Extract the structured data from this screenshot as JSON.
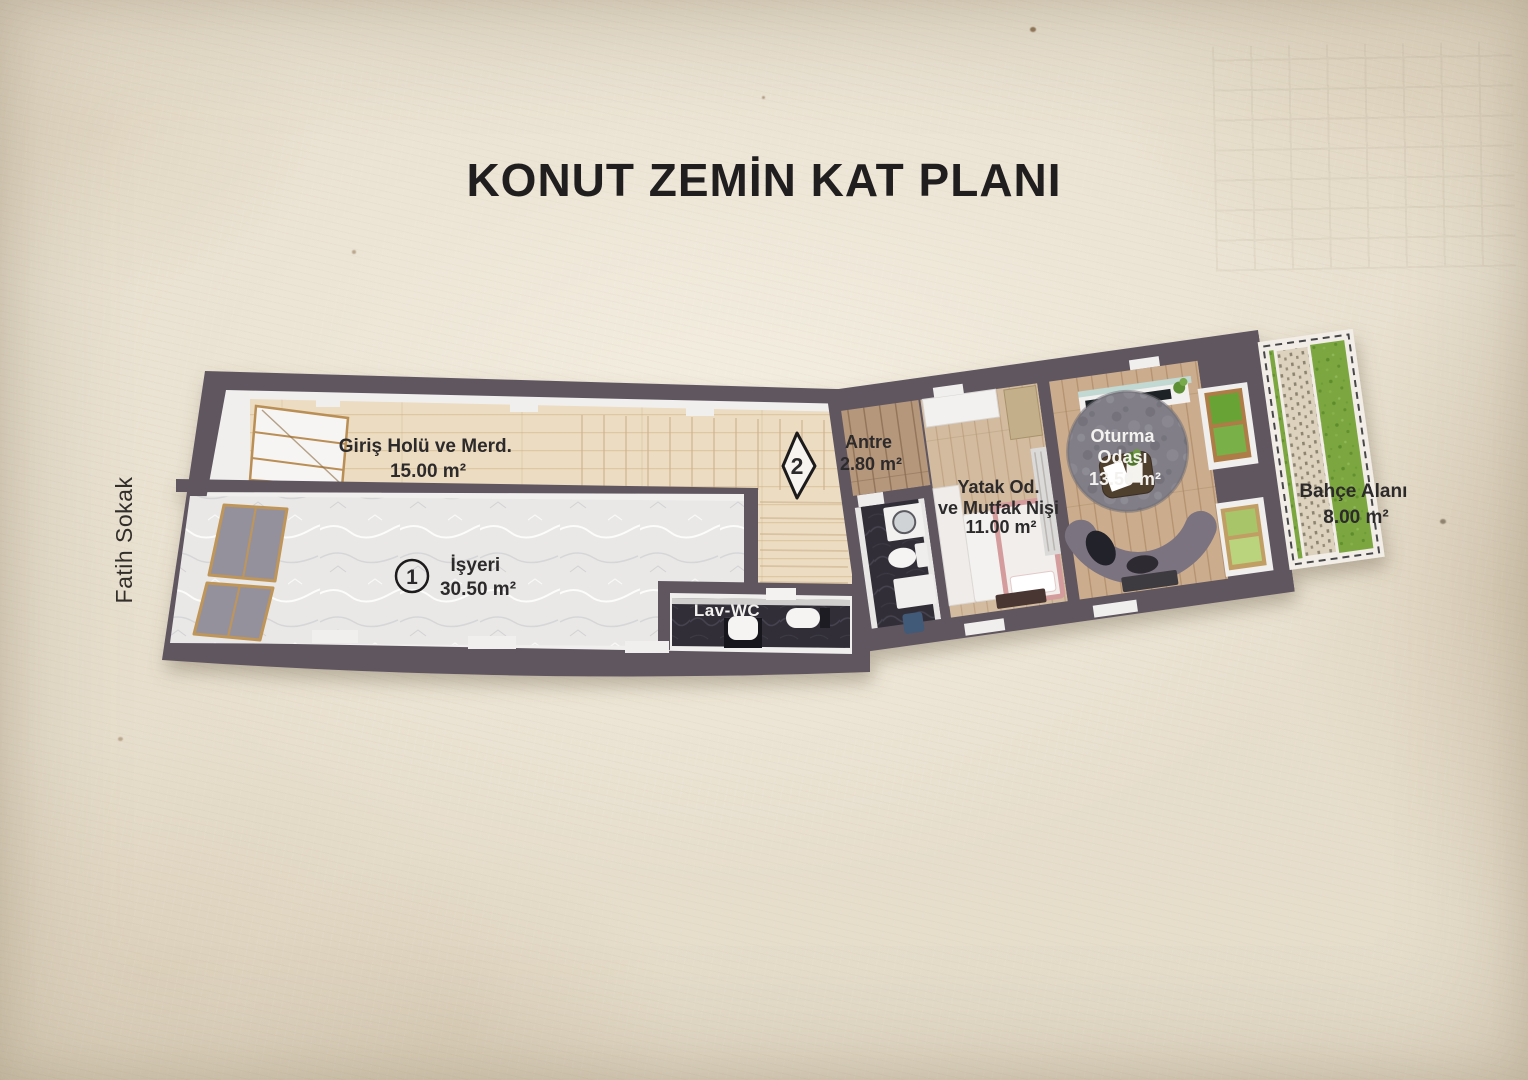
{
  "title": "KONUT ZEMİN KAT PLANI",
  "street": {
    "label": "Fatih Sokak"
  },
  "plan": {
    "rooms": {
      "giris_holu": {
        "name": "Giriş Holü ve Merd.",
        "area": "15.00 m²"
      },
      "isyeri": {
        "name": "İşyeri",
        "area": "30.50 m²"
      },
      "lav_wc": {
        "name": "Lav-WC"
      },
      "antre": {
        "name": "Antre",
        "area": "2.80 m²"
      },
      "yatak": {
        "name_line1": "Yatak Od.",
        "name_line2": "ve Mutfak Nişi",
        "area": "11.00 m²"
      },
      "oturma": {
        "name_line1": "Oturma",
        "name_line2": "Odası",
        "area": "13.50 m²"
      },
      "bahce": {
        "name": "Bahçe Alanı",
        "area": "8.00 m²"
      }
    },
    "markers": {
      "unit": "1",
      "section": "2"
    }
  },
  "colors": {
    "paper": "#e8e0cf",
    "wall": "#5f5661",
    "interior_white": "#f1efed",
    "wood_hall": "#ecdcc2",
    "wood_antre": "#b5977c",
    "wood_bedroom": "#d2bb9f",
    "wood_living": "#cbad8d",
    "marble": "#e9e8e6",
    "dark_floor": "#312f37",
    "grass": "#7ba73f",
    "garden_path": "#dcd2bd",
    "rug": "#817e87",
    "sofa": "#7b7380",
    "bed_accent": "#d49c9c",
    "storefront_glass": "#95919c",
    "window_frame": "#bf9659",
    "text_dark": "#2d2a2b",
    "text_light": "#f4f2ef"
  }
}
